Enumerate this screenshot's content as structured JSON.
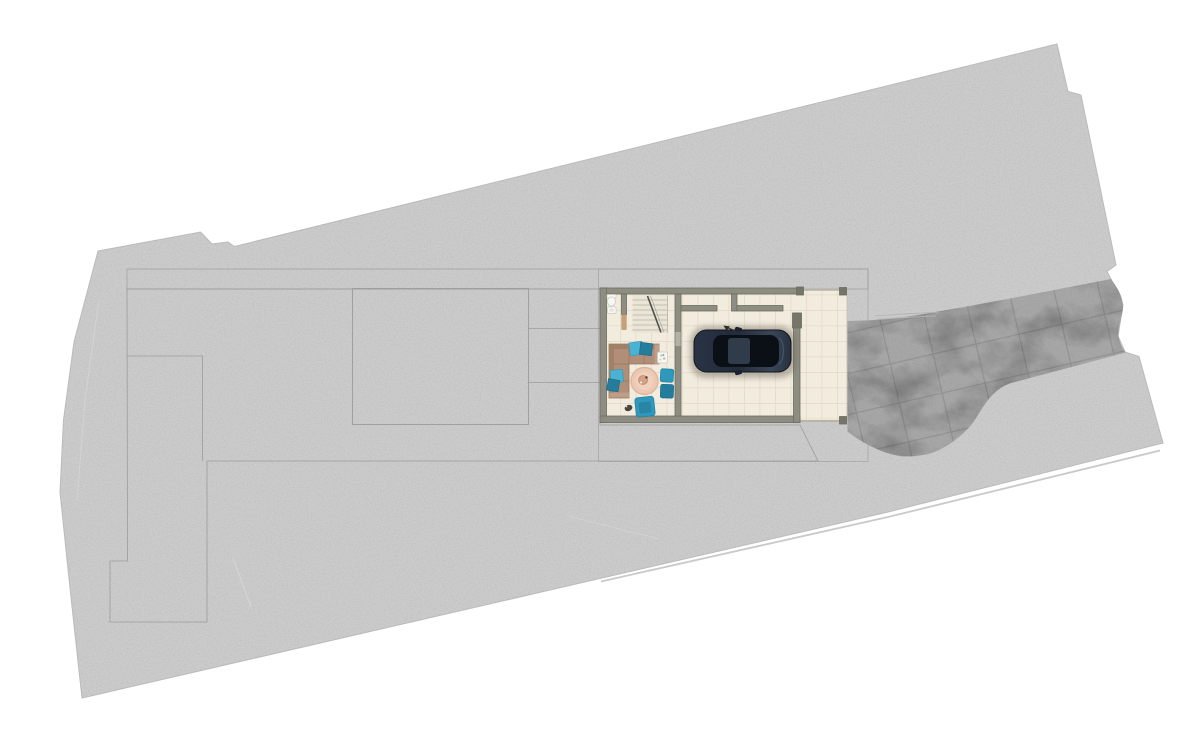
{
  "meta": {
    "kind": "architectural-site-plan",
    "view": "top-down rendered ground-floor plan with site parcel, terrace, house and stone driveway",
    "visible_text": "none"
  },
  "palette": {
    "site_concrete": "#c7c7c7",
    "site_edge": "#b9b9b9",
    "paver_base": "#c5c5c5",
    "paver_line": "#acacac",
    "brick_base": "#b6b6b6",
    "brick_line": "#a2a2a2",
    "stone_base": "#a6a6a6",
    "stone_line": "#8f8f8f",
    "boundary_line": "#9c9c9c",
    "floor_cream": "#f2ecdf",
    "tile_line": "#e3dac7",
    "wall": "#8d8d81",
    "wall_edge": "#6c6c61",
    "wall_dark": "#75756a",
    "sofa": "#b08e77",
    "sofa_line": "#97775f",
    "sofa_light": "#bd9e88",
    "teal_light": "#4cb2d4",
    "teal": "#2f99bd",
    "teal_dark": "#257d9e",
    "rug": "#edc9b4",
    "rug_edge": "#dfb59e",
    "table_wood": "#d3a284",
    "car_body": "#242e3e",
    "car_body_light": "#3c4a60",
    "car_glass": "#0b0f16",
    "fixture_white": "#f7f7f3",
    "door_wood": "#c8a178",
    "road_line": "#c9c9c9",
    "shadow": "#6b6557",
    "scratch": "#d8d8d8"
  },
  "objects": {
    "site": {
      "title": "Site parcel (concrete ground)"
    },
    "terrace": {
      "title": "Paved terrace area"
    },
    "pool_rect": {
      "title": "Marked rectangular zone on terrace"
    },
    "walkway": {
      "title": "Brick-paved strip along the house"
    },
    "driveway": {
      "title": "Natural stone driveway"
    },
    "apron": {
      "title": "Tiled apron in front of garage"
    },
    "building": {
      "title": "House ground floor"
    },
    "bathroom": {
      "title": "Bathroom with toilet and sink"
    },
    "stairs": {
      "title": "Staircase"
    },
    "living": {
      "title": "Living room"
    },
    "sofa": {
      "title": "L-shaped sofa with pillows"
    },
    "rug": {
      "title": "Round rug with coffee table"
    },
    "poufs": {
      "title": "Two teal poufs"
    },
    "armchair": {
      "title": "Teal armchair"
    },
    "side_table": {
      "title": "Side table with plant"
    },
    "garage": {
      "title": "Garage"
    },
    "car": {
      "title": "Dark sedan parked in garage"
    },
    "road_line": {
      "title": "Road edge line"
    }
  }
}
